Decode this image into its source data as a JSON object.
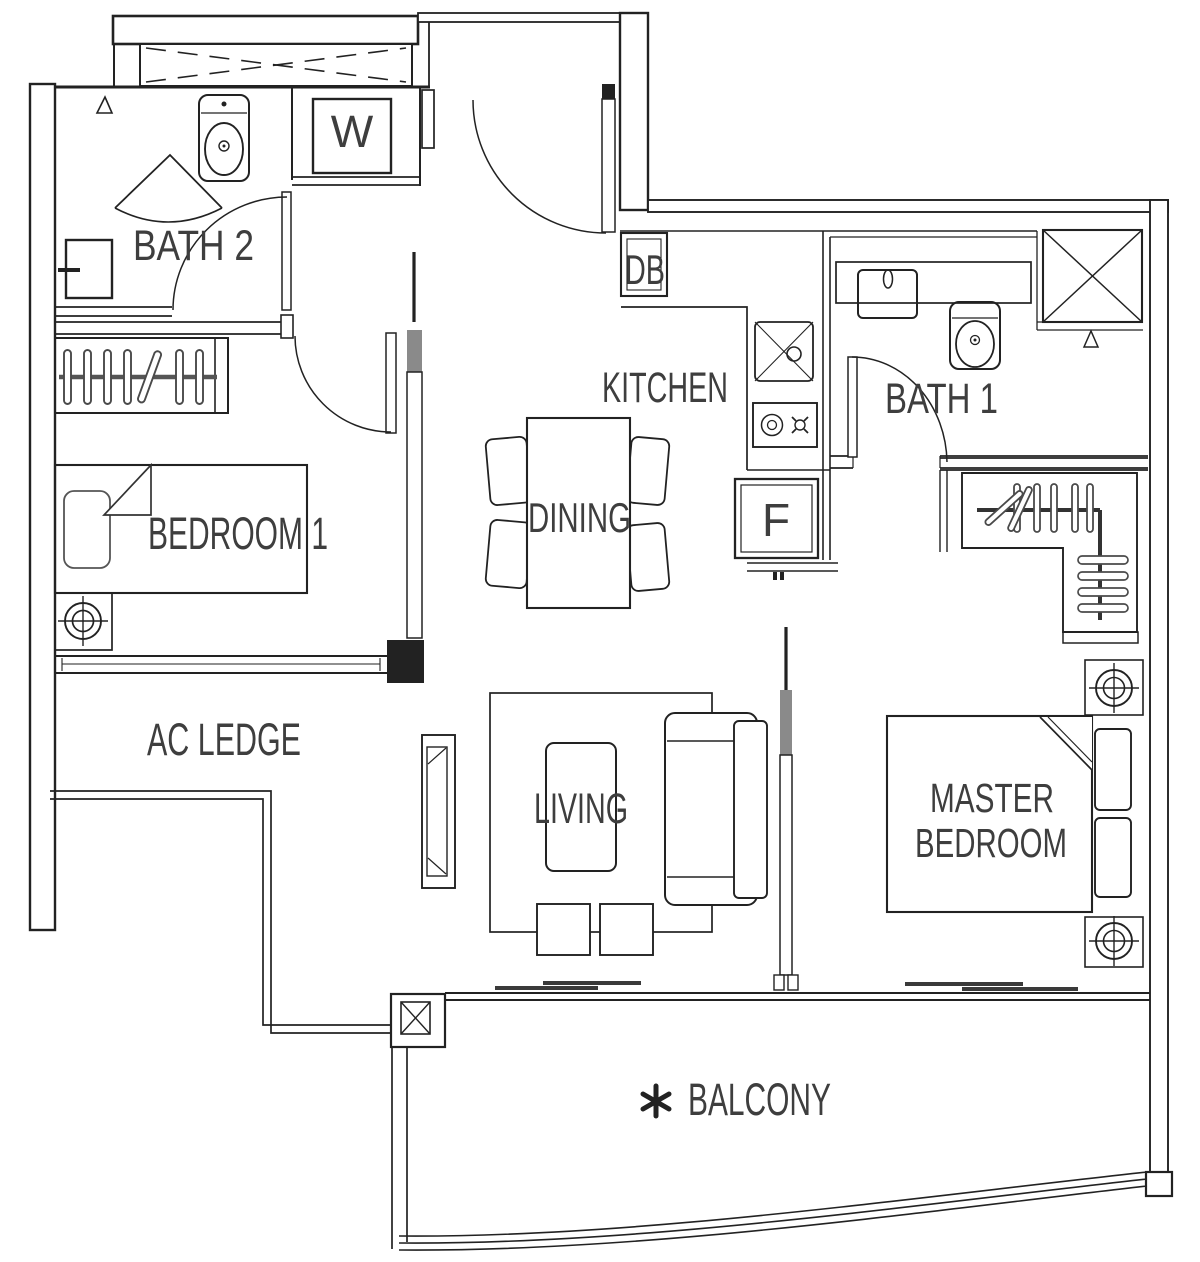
{
  "document": {
    "type": "apartment-floor-plan",
    "units_shown": "none"
  },
  "colors": {
    "background": "#ffffff",
    "line": "#222222",
    "gray_accent": "#8a8a8a",
    "label_text": "#3e3e3e"
  },
  "rooms": {
    "bath2": {
      "label": "BATH 2"
    },
    "laundry": {
      "label": "W"
    },
    "db": {
      "label": "DB"
    },
    "kitchen": {
      "label": "KITCHEN"
    },
    "bath1": {
      "label": "BATH 1"
    },
    "bedroom1": {
      "label": "BEDROOM 1"
    },
    "dining": {
      "label": "DINING"
    },
    "fridge": {
      "label": "F"
    },
    "ac_ledge": {
      "label": "AC LEDGE"
    },
    "living": {
      "label": "LIVING"
    },
    "master": {
      "line1": "MASTER",
      "line2": "BEDROOM"
    },
    "balcony": {
      "label": "BALCONY",
      "marker": "✱"
    }
  },
  "fixtures": {
    "bath2": [
      "corner-shower",
      "toilet",
      "vanity-sink",
      "floor-trap-marker"
    ],
    "laundry": [
      "washing-machine"
    ],
    "kitchen": [
      "distribution-board",
      "counter",
      "sink",
      "cooker-hob",
      "refrigerator"
    ],
    "bath1": [
      "vanity-sink",
      "toilet",
      "shower-stall",
      "floor-trap-marker"
    ],
    "bedroom1": [
      "wardrobe-hangers",
      "single-bed",
      "pillow",
      "column-target",
      "swing-door"
    ],
    "dining": [
      "dining-table",
      "chairs-x4"
    ],
    "living": [
      "rug",
      "coffee-table",
      "sofa",
      "ottomans-x2",
      "tv-console"
    ],
    "master": [
      "l-shaped-wardrobe",
      "double-bed",
      "nightstands-x2",
      "column-targets-x2"
    ],
    "balcony": [
      "structural-column",
      "curved-parapet"
    ],
    "entry": [
      "swing-door"
    ]
  },
  "icons": {
    "balcony_marker": "asterisk"
  }
}
